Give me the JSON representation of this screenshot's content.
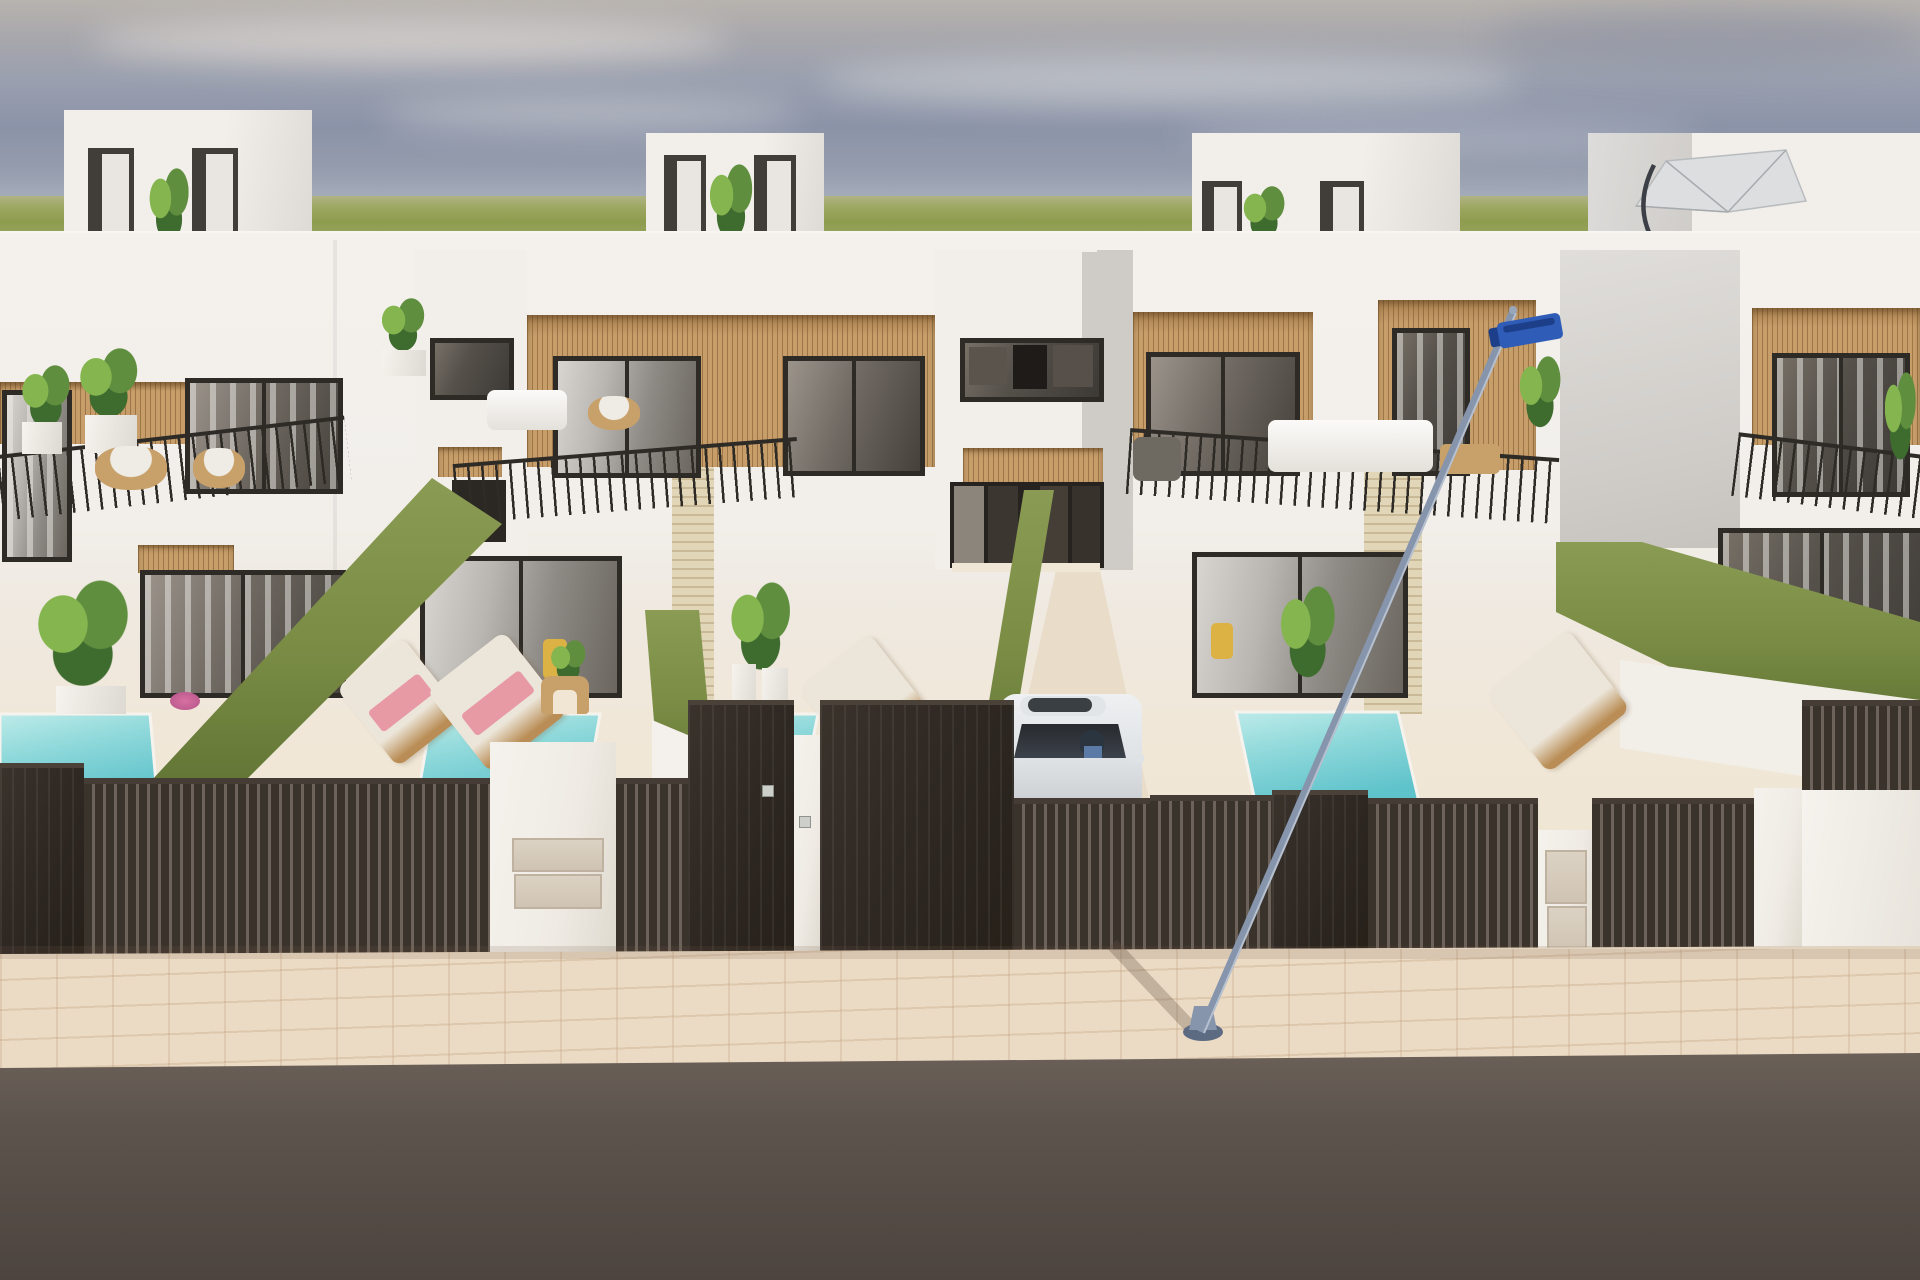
{
  "scene": {
    "description": "3D architectural render, street view of a row of modern two-storey white villas with rooftop terraces and staircase bulkheads, wood-slat facade accents, glass balconies with thin black railings, private turquoise plunge pools, sun loungers with pink and cream towels, green hedge privacy walls, travertine pillars, dark slatted boundary fences with gates and mailbox pillars, a white car parked in a central driveway, a leaning street lamp with a blue luminaire, a cantilever patio umbrella on an upper terrace, a beige paver sidewalk and an asphalt road in the foreground, under a hazy blue-grey sky over a flat green horizon",
    "objects": [
      "hazy sky with thin clouds",
      "green horizon field",
      "rooftop staircase bulkheads with plants",
      "white villa facades",
      "wood slat accent panels",
      "balconies with black metal railings",
      "wicker chairs and white sofas on balconies",
      "turquoise plunge pools",
      "sun loungers with towels",
      "green hedge walls",
      "travertine stone pillars",
      "dark slatted fences and gates",
      "white fence pillars with service panels",
      "white car in driveway",
      "street lamp with blue head",
      "grey patio umbrella",
      "paver sidewalk",
      "asphalt road"
    ],
    "counts": {
      "pools_visible": 4,
      "sun_loungers": 4,
      "cars": 1,
      "street_lamps": 1,
      "umbrellas": 1,
      "rooftop_bulkheads": 3
    }
  },
  "palette": {
    "sky_top": "#b8b3ae",
    "sky_mid": "#8b93a8",
    "sky_low": "#bec2c8",
    "grass": "#8e9c4f",
    "grass_light": "#b0b383",
    "wall": "#f2efeb",
    "wall_shade": "#dedbd6",
    "wall_grey": "#cfccc8",
    "ground": "#f0e6d3",
    "recess": "#413d38",
    "door": "#e9e6e1",
    "wood": "#c79e6a",
    "wood_dark": "#a87f4e",
    "frame": "#2e2a26",
    "stone": "#e2d6b8",
    "hedge": "#7b8d45",
    "hedge_dark": "#5e7233",
    "pool": "#8ed8da",
    "pool_deep": "#5fc3cb",
    "pool_light": "#bdebe9",
    "fence": "#3a332c",
    "fence_gap": "#6e635a",
    "gate": "#2f2823",
    "pillar": "#efebe4",
    "panel": "#dcd2c3",
    "walk": "#ecdbc4",
    "road": "#5d544d",
    "road_dark": "#4c443e",
    "pole": "#8695ac",
    "pole_dark": "#5c6b82",
    "sign": "#2f5cb7",
    "sign_dark": "#1d3f8a",
    "car_body": "#eef0f1",
    "car_glass": "#272a2e",
    "plant": "#5f8f3e",
    "plant_dark": "#3e6b2e",
    "plant_light": "#85b54e",
    "lounger": "#ece6da",
    "lounger_wood": "#b98d55",
    "towel": "#e79aa4",
    "towel_deep": "#d76fa3",
    "rattan": "#c8a06a",
    "chair_yellow": "#ddb245",
    "umbrella": "#dcdedf"
  }
}
